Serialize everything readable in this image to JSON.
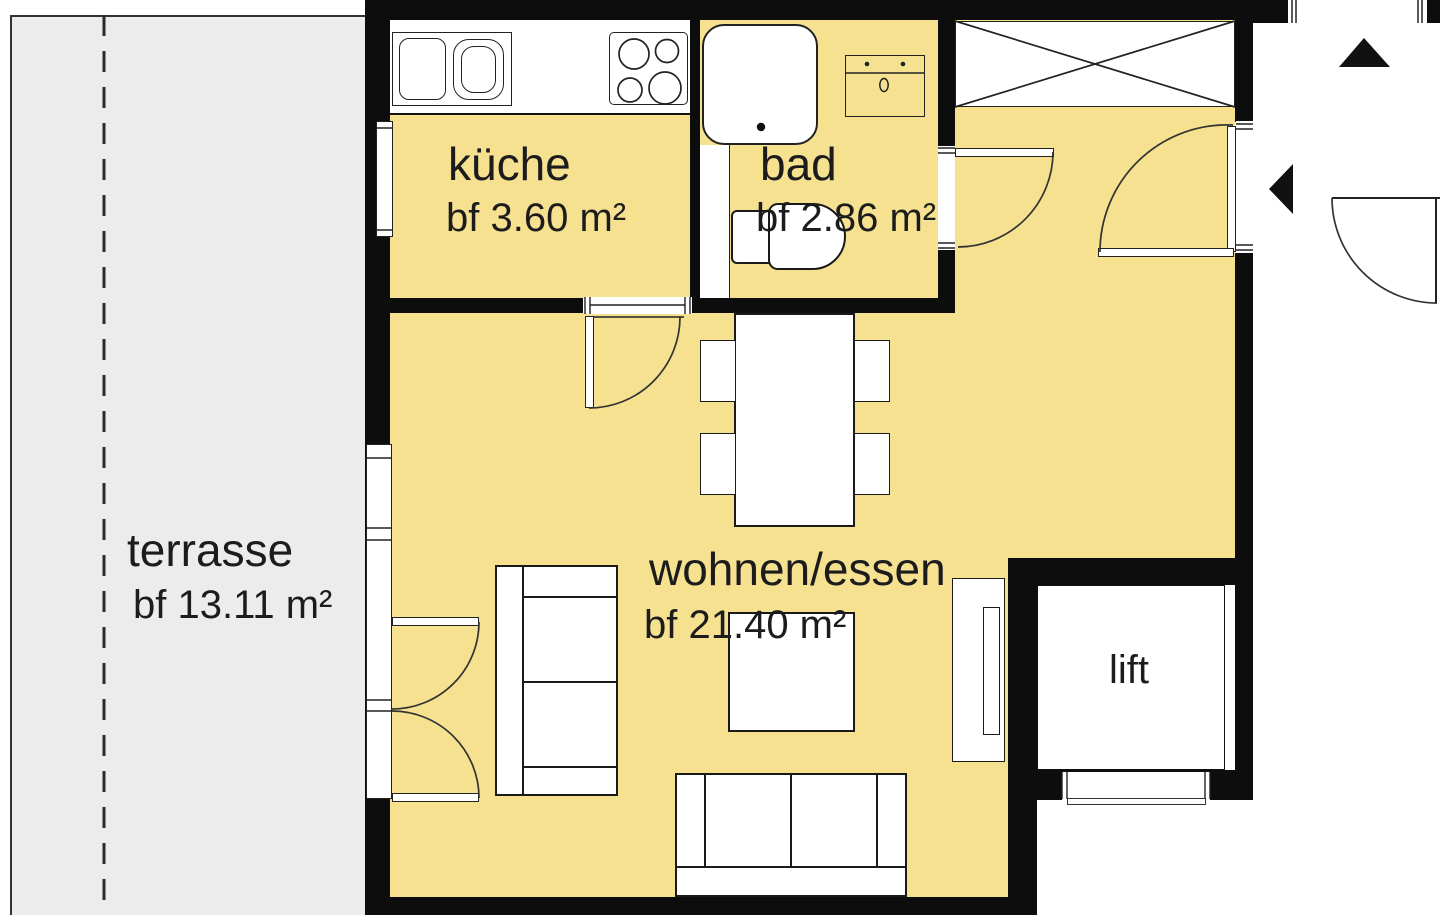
{
  "plan": {
    "rooms": {
      "terrasse": {
        "label": "terrasse",
        "area": "bf 13.11 m²"
      },
      "kueche": {
        "label": "küche",
        "area": "bf 3.60 m²"
      },
      "bad": {
        "label": "bad",
        "area": "bf 2.86 m²"
      },
      "wohnen_essen": {
        "label": "wohnen/essen",
        "area": "bf 21.40 m²"
      },
      "lift": {
        "label": "lift"
      }
    },
    "colors": {
      "floor": "#F5E190",
      "terrace": "#ECECEC",
      "wall": "#0D0D0D",
      "line": "#222222"
    }
  }
}
